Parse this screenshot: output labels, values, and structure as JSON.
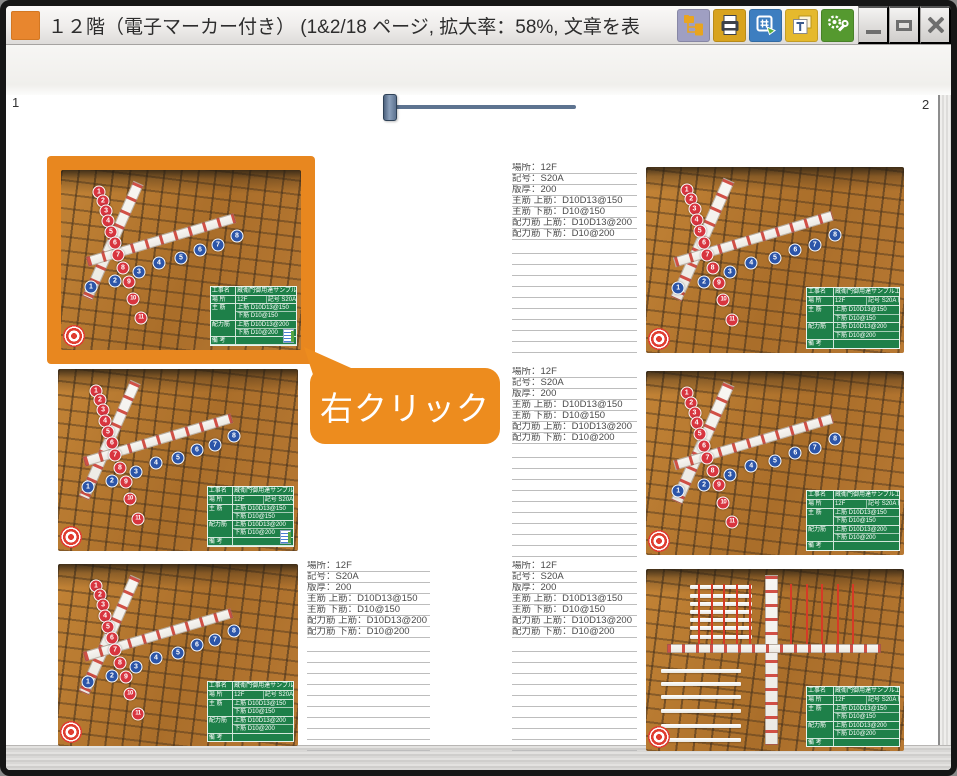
{
  "window": {
    "title": "１２階（電子マーカー付き） (1&2/18 ページ, 拡大率：58%, 文章を表",
    "toolbar_icons": [
      "pages-tree-icon",
      "print-icon",
      "numbering-stamp-icon",
      "text-stamp-icon",
      "settings-icon"
    ],
    "controls": [
      "minimize",
      "maximize",
      "close"
    ]
  },
  "spread": {
    "left_page_number": "1",
    "right_page_number": "2",
    "callout_label": "右クリック",
    "spec_lines": [
      "場所：12F",
      "記号：S20A",
      "版厚：200",
      "主筋 上筋：D10D13@150",
      "主筋 下筋：D10@150",
      "配力筋 上筋：D10D13@200",
      "配力筋 下筋：D10@200"
    ],
    "empty_rule_count": 10,
    "markers": {
      "red": [
        "1",
        "2",
        "3",
        "4",
        "5",
        "6",
        "7",
        "8",
        "9",
        "10",
        "11"
      ],
      "blue": [
        "1",
        "2",
        "3",
        "4",
        "5",
        "6",
        "7",
        "8"
      ]
    },
    "board": {
      "rows": [
        {
          "label": "工事名",
          "cells": [
            "蔵衛門御用達サンプル工事"
          ]
        },
        {
          "label": "場 所",
          "cells": [
            "12F",
            "記号 S20A 版厚 200"
          ]
        },
        {
          "label": "主 筋",
          "cells": [
            "上筋 D10D13@150",
            "下筋 D10@150"
          ],
          "stacked": true
        },
        {
          "label": "配力筋",
          "cells": [
            "上筋 D10D13@200",
            "下筋 D10@200"
          ],
          "stacked": true
        },
        {
          "label": "備 考",
          "cells": [
            ""
          ]
        }
      ]
    }
  },
  "colors": {
    "accent_orange": "#ed8c1e",
    "highlight_orange": "#e8871f",
    "board_green": "#1e8049",
    "marker_red": "#d8353f",
    "marker_blue": "#2c55a8"
  }
}
